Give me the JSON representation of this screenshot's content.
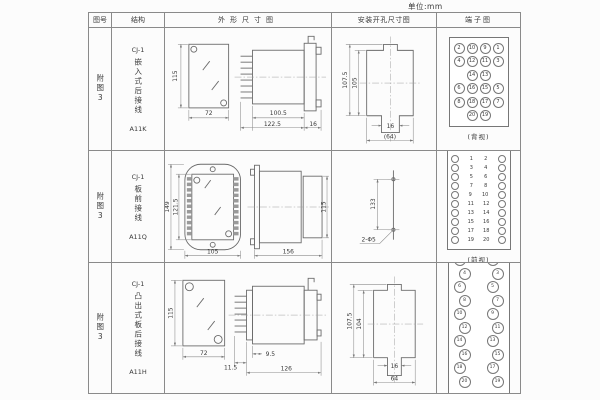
{
  "unit_label": "单位:mm",
  "headers": {
    "fig_no": "图号",
    "structure": "结构",
    "outline": "外形尺寸图",
    "install": "安装开孔尺寸图",
    "terminal": "端子图"
  },
  "rows": [
    {
      "fig_no": "附图3",
      "structure": {
        "model": "CJ-1",
        "desc": "嵌入式后接线",
        "code": "A11K"
      },
      "outline_dims": {
        "front_height": "115",
        "front_width": "72",
        "body_depth": "100.5",
        "total_depth": "122.5",
        "flange_depth": "16"
      },
      "install_dims": {
        "outer_height": "107.5",
        "inner_height": "105",
        "slot_width": "16",
        "cutout_width": "(64)"
      },
      "terminal": {
        "grid": [
          [
            "2",
            "10",
            "9",
            "1"
          ],
          [
            "4",
            "12",
            "11",
            "3"
          ],
          [
            "",
            "14",
            "13",
            ""
          ],
          [
            "6",
            "16",
            "15",
            "5"
          ],
          [
            "8",
            "18",
            "17",
            "7"
          ],
          [
            "",
            "20",
            "19",
            ""
          ]
        ],
        "view_label": "(背视)"
      }
    },
    {
      "fig_no": "附图3",
      "structure": {
        "model": "CJ-1",
        "desc": "板前接线",
        "code": "A11Q"
      },
      "outline_dims": {
        "front_outer_height": "149",
        "front_inner_height": "121.5",
        "front_width": "105",
        "total_depth": "156",
        "side_height": "115"
      },
      "install_dims": {
        "hole_spacing": "133",
        "hole_label": "2-Φ5"
      },
      "terminal": {
        "pairs": [
          [
            "1",
            "2"
          ],
          [
            "3",
            "4"
          ],
          [
            "5",
            "6"
          ],
          [
            "7",
            "8"
          ],
          [
            "9",
            "10"
          ],
          [
            "11",
            "12"
          ],
          [
            "13",
            "14"
          ],
          [
            "15",
            "16"
          ],
          [
            "17",
            "18"
          ],
          [
            "19",
            "20"
          ]
        ],
        "view_label": "(前视)"
      }
    },
    {
      "fig_no": "附图3",
      "structure": {
        "model": "CJ-1",
        "desc": "凸出式板后接线",
        "code": "A11H"
      },
      "outline_dims": {
        "front_height": "115",
        "front_width": "72",
        "pin_depth": "11.5",
        "stud_depth": "9.5",
        "total_depth": "126"
      },
      "install_dims": {
        "outer_height": "107.5",
        "inner_height": "104",
        "slot_width": "16",
        "cutout_width": "64"
      },
      "terminal": {
        "pairs": [
          [
            "2",
            "1"
          ],
          [
            "4",
            "3"
          ],
          [
            "6",
            "5"
          ],
          [
            "8",
            "7"
          ],
          [
            "10",
            "9"
          ],
          [
            "12",
            "11"
          ],
          [
            "14",
            "13"
          ],
          [
            "16",
            "15"
          ],
          [
            "18",
            "17"
          ],
          [
            "20",
            "19"
          ]
        ],
        "view_label": "(背视)"
      }
    }
  ]
}
